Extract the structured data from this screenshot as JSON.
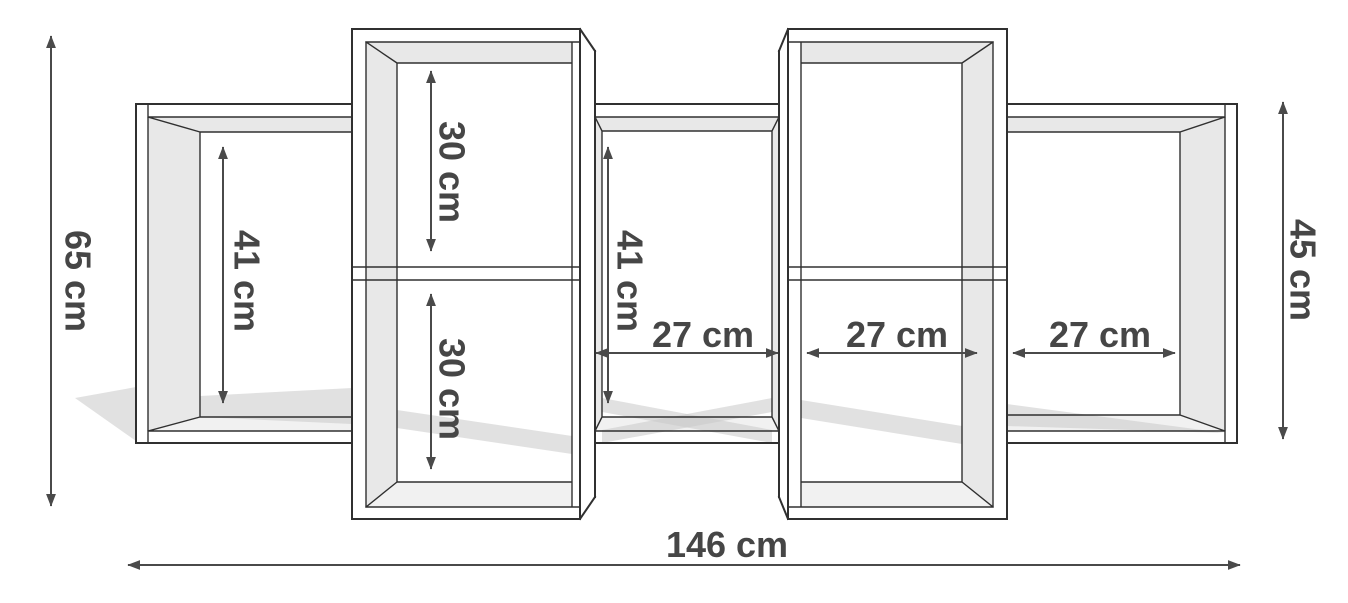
{
  "diagram": {
    "type": "furniture-dimension-drawing",
    "subject": "wall shelf front view with compartments and cast shadow",
    "unit": "cm",
    "dimensions": {
      "overall_height_left": "65 cm",
      "overall_width_bottom": "146 cm",
      "overall_height_right": "45 cm",
      "left_compartment_height": "41 cm",
      "left_column_top_cell_height": "30 cm",
      "left_column_bottom_cell_height": "30 cm",
      "center_compartment_height": "41 cm",
      "center_compartment_width": "27 cm",
      "right_column_cell_width": "27 cm",
      "right_compartment_width": "27 cm"
    },
    "colors": {
      "background": "#ffffff",
      "line": "#303030",
      "panel_face": "#e8e8e8",
      "floor_face": "#f1f1f1",
      "shadow": "#c8c8c8",
      "dimension": "#4a4a4a"
    }
  }
}
